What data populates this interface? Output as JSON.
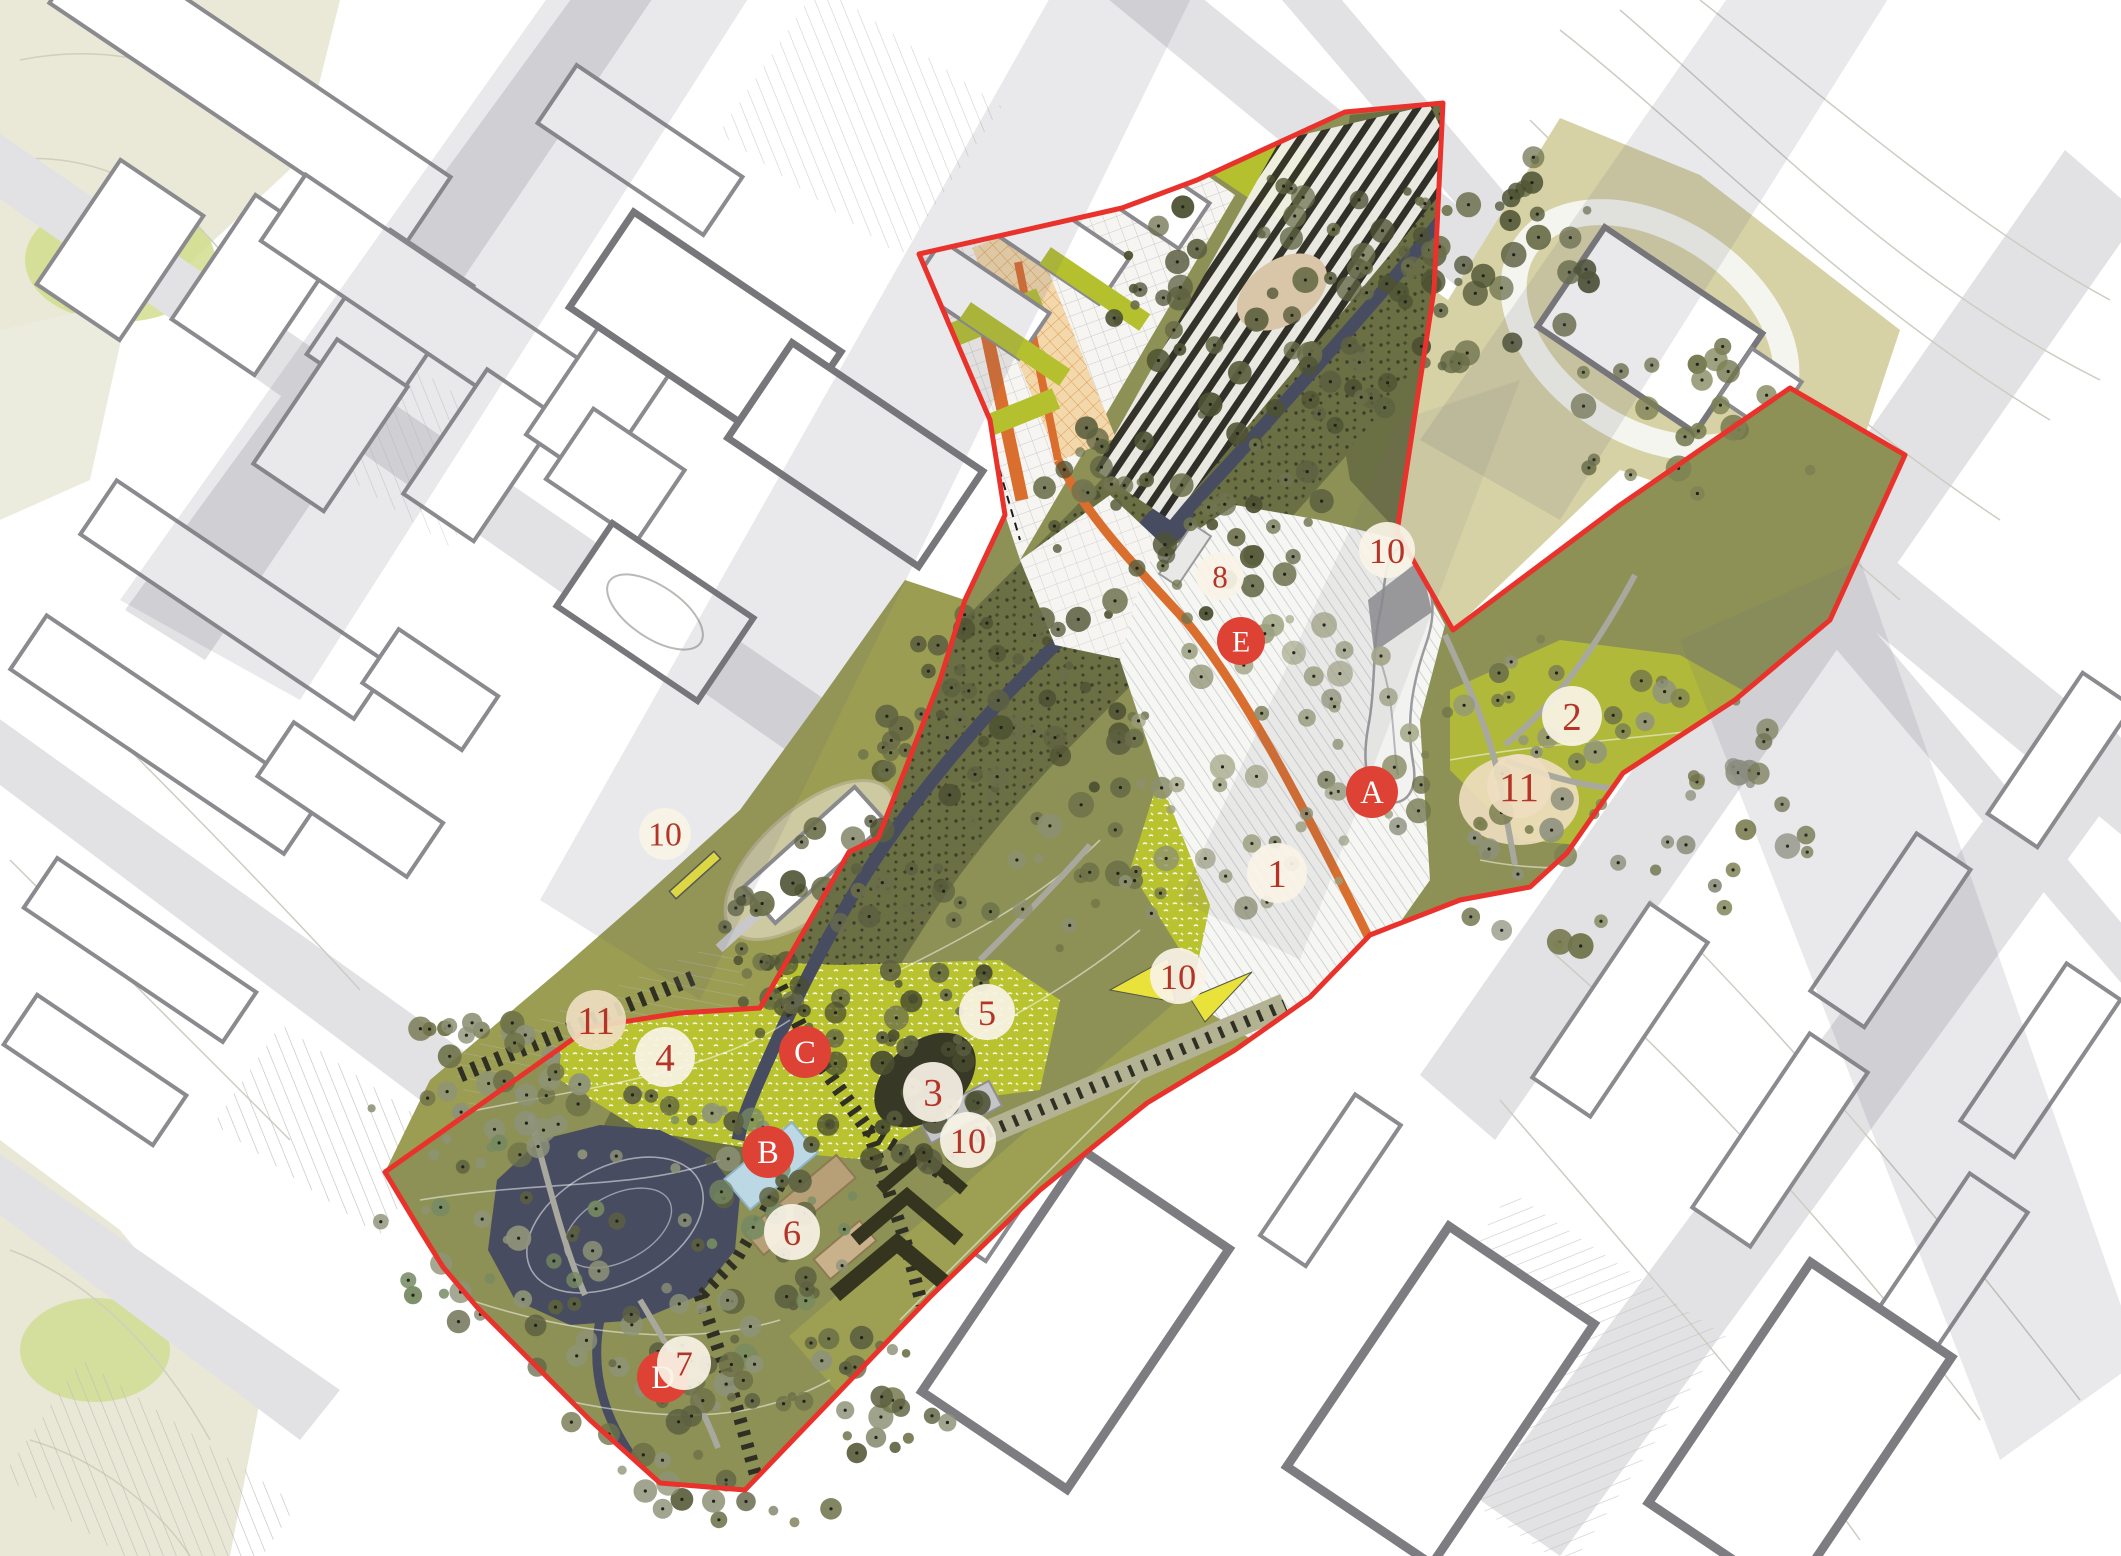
{
  "map": {
    "kind": "landscape-master-plan",
    "colors": {
      "boundary_red": "#e8322b",
      "orange_path": "#d96e2e",
      "pond": "#474c60",
      "water_light": "#bdd8e5",
      "olive_base": "#8d9155",
      "olive_light": "#9da052",
      "wood_dark": "#6b6f44",
      "meadow_bright": "#b9c22f",
      "khaki": "#d6d2a6",
      "street_gray": "#e2e2e4",
      "building_stroke": "#8b8b8f",
      "marker_letter_bg": "#dd4234",
      "marker_letter_text": "#ffffff",
      "marker_number_text": "#b43527",
      "marker_number_bg": "#f8f3e6",
      "marker_number_bg_cream": "#eedec0"
    },
    "markers": [
      {
        "label": "A",
        "type": "letter",
        "x": 1372,
        "y": 792,
        "r": 26
      },
      {
        "label": "B",
        "type": "letter",
        "x": 768,
        "y": 1152,
        "r": 26
      },
      {
        "label": "C",
        "type": "letter",
        "x": 805,
        "y": 1052,
        "r": 26
      },
      {
        "label": "D",
        "type": "letter",
        "x": 663,
        "y": 1377,
        "r": 26
      },
      {
        "label": "E",
        "type": "letter",
        "x": 1241,
        "y": 641,
        "r": 24
      },
      {
        "label": "1",
        "type": "number",
        "x": 1277,
        "y": 873,
        "r": 30,
        "tint": "light"
      },
      {
        "label": "2",
        "type": "number",
        "x": 1572,
        "y": 716,
        "r": 30,
        "tint": "light"
      },
      {
        "label": "3",
        "type": "number",
        "x": 933,
        "y": 1092,
        "r": 30,
        "tint": "light"
      },
      {
        "label": "4",
        "type": "number",
        "x": 665,
        "y": 1057,
        "r": 30,
        "tint": "light"
      },
      {
        "label": "5",
        "type": "number",
        "x": 987,
        "y": 1012,
        "r": 28,
        "tint": "light"
      },
      {
        "label": "6",
        "type": "number",
        "x": 792,
        "y": 1232,
        "r": 28,
        "tint": "light"
      },
      {
        "label": "7",
        "type": "number",
        "x": 684,
        "y": 1363,
        "r": 27,
        "tint": "light"
      },
      {
        "label": "8",
        "type": "number",
        "x": 1220,
        "y": 576,
        "r": 24,
        "tint": "light"
      },
      {
        "label": "10",
        "type": "number",
        "x": 1387,
        "y": 550,
        "r": 28,
        "tint": "light"
      },
      {
        "label": "10",
        "type": "number",
        "x": 1178,
        "y": 976,
        "r": 28,
        "tint": "light"
      },
      {
        "label": "10",
        "type": "number",
        "x": 968,
        "y": 1140,
        "r": 28,
        "tint": "light"
      },
      {
        "label": "10",
        "type": "number",
        "x": 665,
        "y": 834,
        "r": 26,
        "tint": "light"
      },
      {
        "label": "11",
        "type": "number",
        "x": 1519,
        "y": 786,
        "r": 32,
        "tint": "cream"
      },
      {
        "label": "11",
        "type": "number",
        "x": 596,
        "y": 1020,
        "r": 30,
        "tint": "cream"
      }
    ]
  }
}
